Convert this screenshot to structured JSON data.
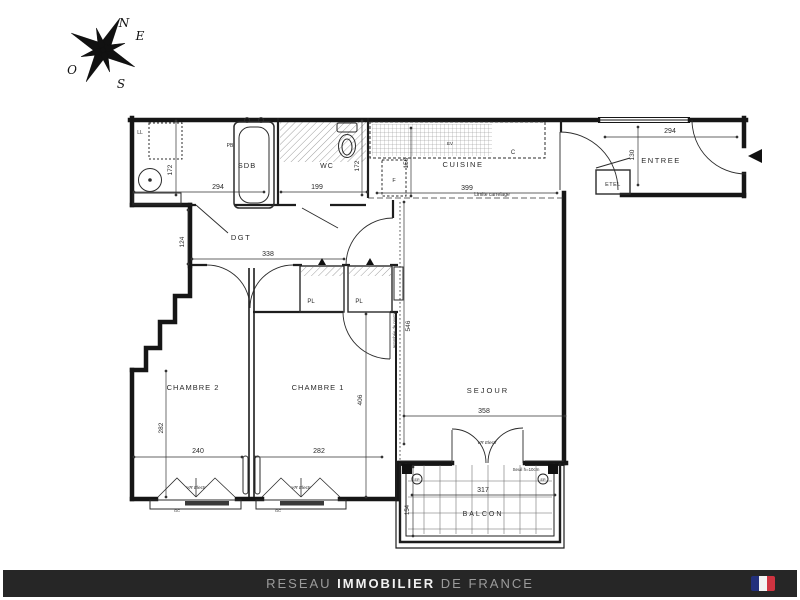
{
  "compass": {
    "n": "N",
    "e": "E",
    "s": "S",
    "o": "O"
  },
  "rooms": {
    "sdb": "SDB",
    "wc": "WC",
    "cuisine": "CUISINE",
    "entree": "ENTREE",
    "etel": "ETEL",
    "dgt": "DGT",
    "pl": "PL",
    "chambre2": "CHAMBRE 2",
    "chambre1": "CHAMBRE 1",
    "sejour": "SEJOUR",
    "balcon": "BALCON"
  },
  "fixtures": {
    "ll": "LL",
    "pb": "PB",
    "f": "F",
    "c": "C",
    "ev": "EV",
    "ep": "EP",
    "gc": "GC"
  },
  "dimensions": {
    "sdb_w": "294",
    "sdb_d": "172",
    "wc_w": "199",
    "wc_d": "172",
    "cuisine_w": "399",
    "cuisine_d": "150",
    "entree_w": "294",
    "entree_d": "130",
    "dgt_w": "338",
    "dgt_d": "124",
    "sejour_w": "358",
    "sejour_h": "546",
    "ch2_w": "240",
    "ch2_h": "282",
    "ch1_w": "282",
    "ch1_h": "406",
    "balcon_w": "317",
    "balcon_d": "154"
  },
  "annotations": {
    "limite": "Limite carrelage",
    "retombee": "retombée de poutre",
    "seuil": "Seuil h=10cm",
    "vr": "VR Electr"
  },
  "footer": {
    "reseau": "RESEAU ",
    "immobilier": "IMMOBILIER",
    "de_france": " DE FRANCE"
  },
  "colors": {
    "line": "#1a1a1a",
    "footer_bg": "#262626",
    "flag_blue": "#23307c",
    "flag_white": "#f2f2f2",
    "flag_red": "#cf3340"
  }
}
